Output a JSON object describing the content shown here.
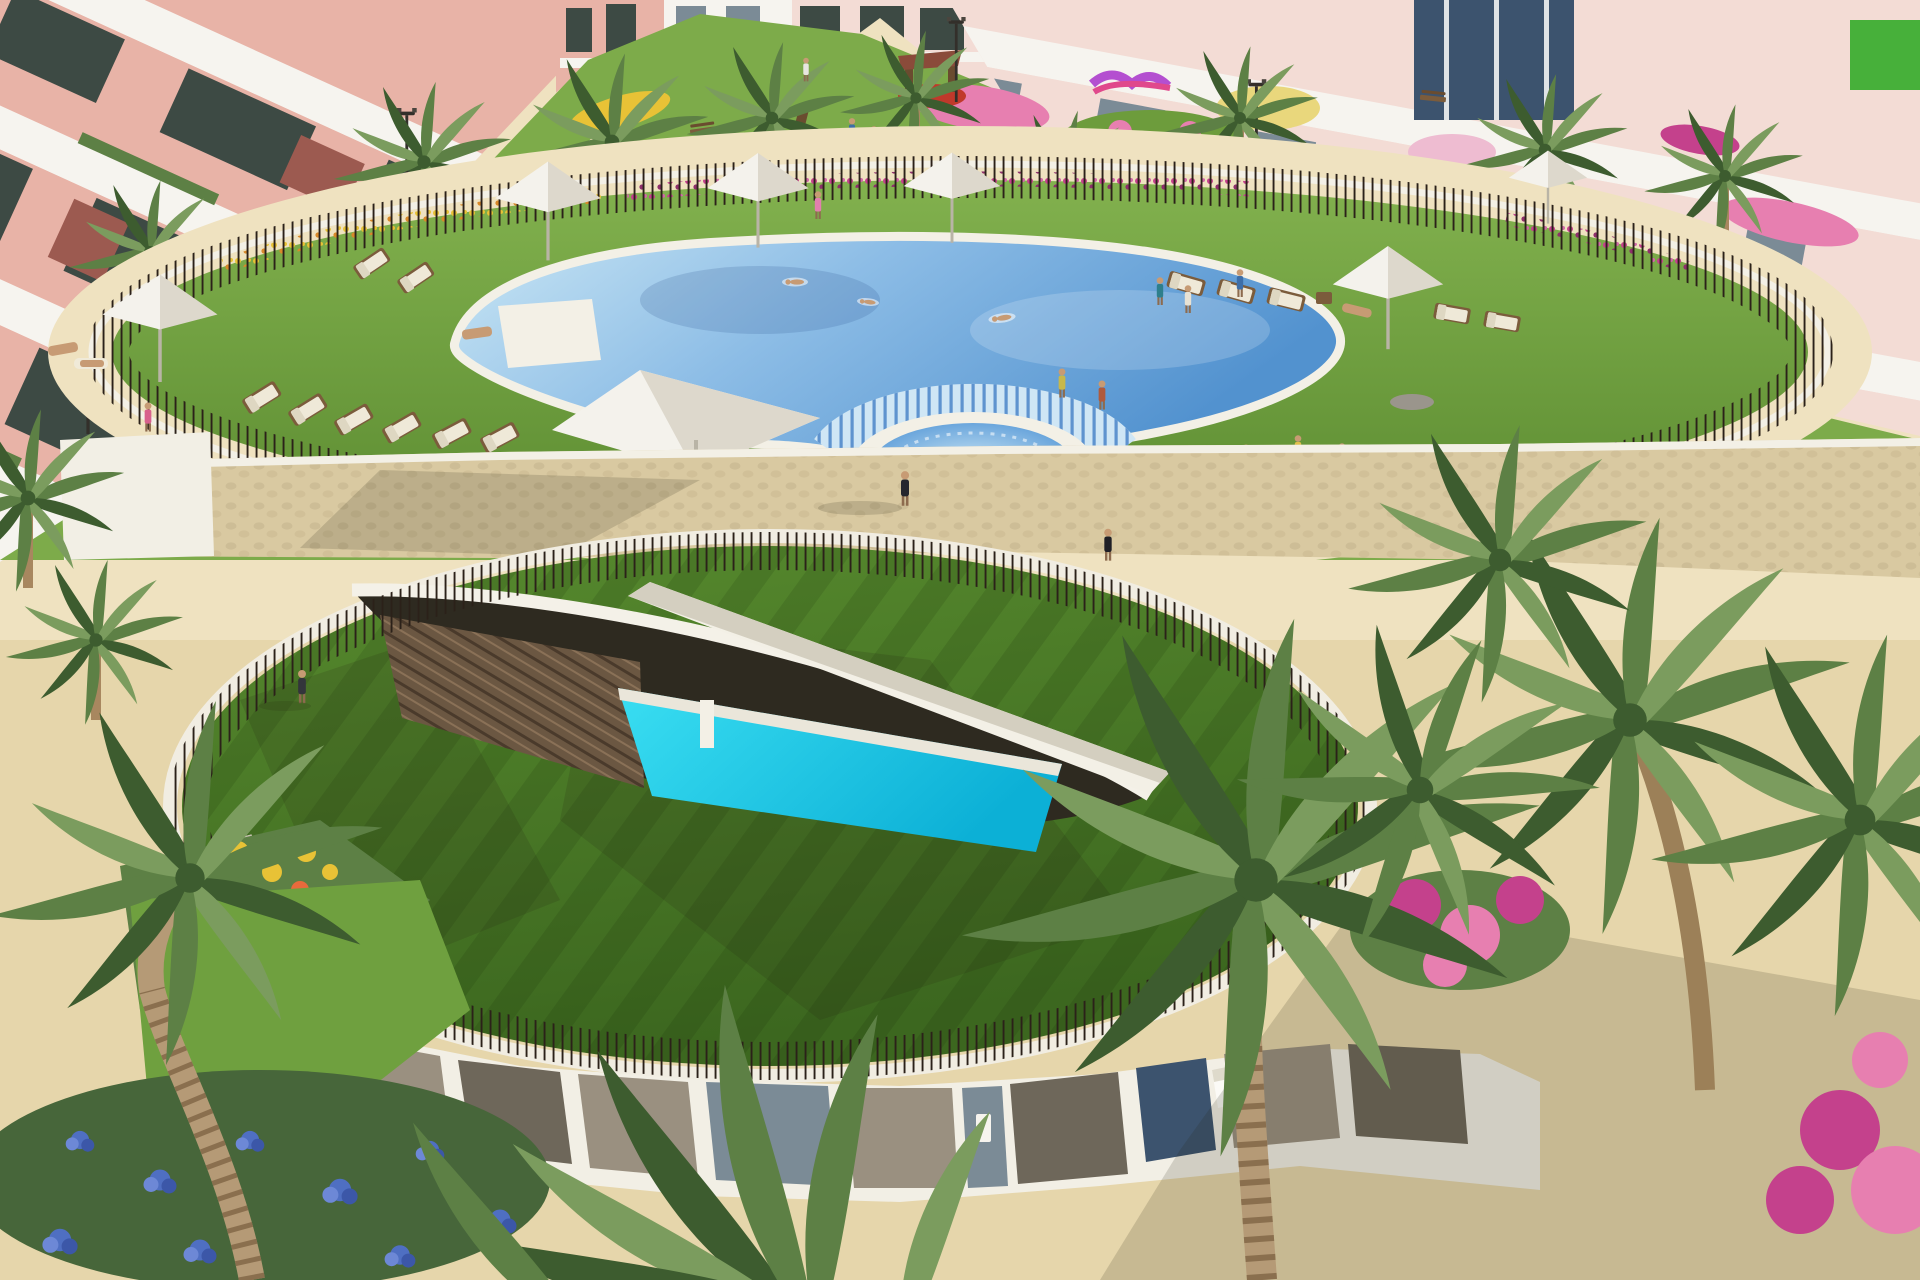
{
  "scene": {
    "type": "architectural-render",
    "description": "Aerial 3D rendering of a residential resort complex: pink apartment blocks with white balconies surround a landscaped garden; an oval lawn terrace holds a large free-form swimming pool with a cascading step edge into a round spa pool, white square sun canopies and rows of loungers; below, a circular green-roofed clubhouse with a spiked railing has a lens-shaped opening revealing a turquoise indoor pool and a glazed facade with a fire bowl; palm trees, flower beds and sandy paths fill the foreground.",
    "people_visible_approx": 25,
    "elements": [
      {
        "name": "apartment-building-left",
        "label": "pink apartment block with white balconies"
      },
      {
        "name": "apartment-building-right",
        "label": "light pink apartment block with balconies"
      },
      {
        "name": "garden-park",
        "label": "communal garden with playground, benches and flower beds"
      },
      {
        "name": "lawn-terrace",
        "label": "oval lawn terrace with perimeter spike fence"
      },
      {
        "name": "main-pool",
        "label": "free-form outdoor swimming pool"
      },
      {
        "name": "cascade-steps",
        "label": "stepped cascade edge between pools"
      },
      {
        "name": "spa-pool",
        "label": "round spa pool with bathers"
      },
      {
        "name": "pool-canopy",
        "label": "white square shade sail over pool edge"
      },
      {
        "name": "umbrellas",
        "label": "white square garden umbrellas"
      },
      {
        "name": "sun-loungers",
        "label": "wooden loungers with white cushions"
      },
      {
        "name": "stone-path",
        "label": "beige cobblestone walkway"
      },
      {
        "name": "clubhouse-green-roof",
        "label": "circular green roof with spike railing"
      },
      {
        "name": "roof-opening",
        "label": "lens-shaped roof opening with white beam"
      },
      {
        "name": "indoor-pool",
        "label": "turquoise lower-level pool with wood deck"
      },
      {
        "name": "clubhouse-facade",
        "label": "white-framed glass facade"
      },
      {
        "name": "fire-bowl",
        "label": "white cube fire bowl with flame"
      },
      {
        "name": "palm-trees",
        "label": "palm trees"
      },
      {
        "name": "hydrangea-bed",
        "label": "blue hydrangea flower bed"
      },
      {
        "name": "bougainvillea",
        "label": "magenta bougainvillea shrubs"
      }
    ]
  },
  "colors": {
    "sand": "#e6d6ab",
    "sand_light": "#efe2c0",
    "sand_shadow": "#c9b287",
    "cobble": "#d9c9a1",
    "lawn": "#6fa03f",
    "lawn_dark": "#547f2c",
    "park": "#7dab4a",
    "roof_green": "#4a7a28",
    "roof_dark": "#36601c",
    "pool_light": "#c9e6f4",
    "pool_mid": "#7fb6e2",
    "pool_deep": "#5292cf",
    "cyan": "#14c8e8",
    "rim": "#f3f0e6",
    "fence": "#2b2119",
    "canopy": "#f4f2ec",
    "canopy_shade": "#ddd8cc",
    "bldg_pink": "#e8b3a7",
    "bldg_pink_light": "#f3dcd5",
    "bldg_white": "#f6f4ef",
    "window_dark": "#3d4a44",
    "glass_grey": "#7b8b96",
    "glass_tan": "#9a9080",
    "glass_dark": "#6e675a",
    "glass_blue": "#3c536e",
    "trunk": "#a8875f",
    "trunk_dark": "#7d6243",
    "frond": "#5d8045",
    "frond_dark": "#3d5c2f",
    "frond_light": "#7b9c5e",
    "flower_pink": "#e77fb0",
    "flower_magenta": "#c4418c",
    "flower_yellow": "#e8c236",
    "flower_blue": "#4f6fc2",
    "flower_red": "#c0392b",
    "skin": "#c79b74",
    "wood": "#7b5c3c",
    "pad": "#efe9d8",
    "fire": "#ff7d21",
    "fire_core": "#ffc23d",
    "wall_white": "#f2efe5",
    "deck_wood": "#6b5742"
  }
}
